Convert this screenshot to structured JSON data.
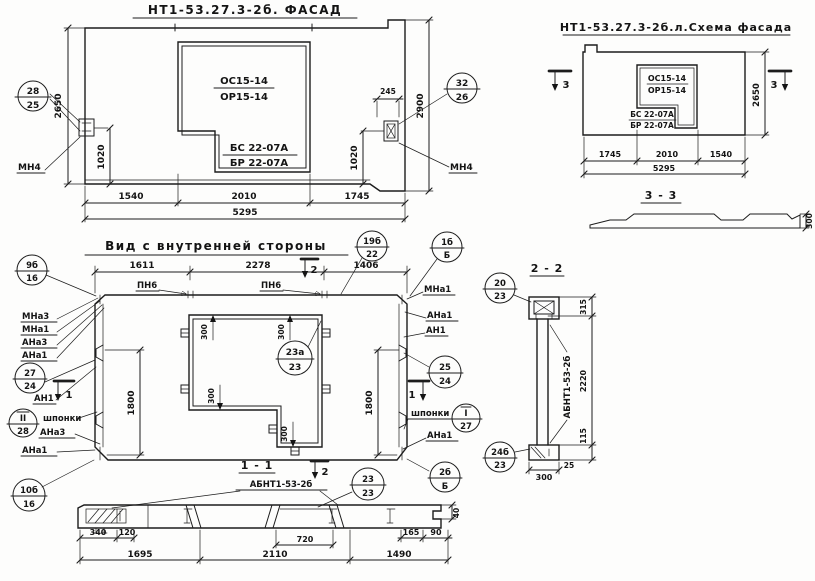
{
  "shared": {
    "abnt": "АБНТ1-53-2б"
  },
  "facade": {
    "title": "НТ1-53.27.3-2б. ФАСАД",
    "win_top": "ОС15-14",
    "win_bot": "ОР15-14",
    "lintel_top": "БС 22-07А",
    "lintel_bot": "БР 22-07А",
    "mn4": "МН4",
    "callout_left": {
      "top": "28",
      "bot": "25"
    },
    "callout_right": {
      "top": "32",
      "bot": "26"
    },
    "d2650": "2650",
    "d2900": "2900",
    "d1020": "1020",
    "d245": "245",
    "d1540": "1540",
    "d2010": "2010",
    "d1745": "1745",
    "d5295": "5295"
  },
  "schema": {
    "title": "НТ1-53.27.3-2б.л.Схема фасада",
    "win_top": "ОС15-14",
    "win_bot": "ОР15-14",
    "lintel_top": "БС 22-07А",
    "lintel_bot": "БР 22-07А",
    "mark3": "3",
    "d2650": "2650",
    "d1745": "1745",
    "d2010": "2010",
    "d1540": "1540",
    "d5295": "5295",
    "s33_title": "3 - 3",
    "d300": "300"
  },
  "inner": {
    "title": "Вид с внутренней стороны",
    "d1611": "1611",
    "d2278": "2278",
    "d1406": "1406",
    "pn6": "ПН6",
    "mark1": "1",
    "mark2": "2",
    "mna3": "МНа3",
    "mna1": "МНа1",
    "ana3": "АНа3",
    "ana1": "АНа1",
    "an1": "АН1",
    "shponki": "шпонки",
    "d300": "300",
    "d1800": "1800",
    "c9b": {
      "top": "9б",
      "bot": "16"
    },
    "c19b": {
      "top": "19б",
      "bot": "22"
    },
    "c1b": {
      "top": "1б",
      "bot": "Б"
    },
    "c27": {
      "top": "27",
      "bot": "24"
    },
    "cII": {
      "top": "II",
      "bot": "28"
    },
    "c10b": {
      "top": "10б",
      "bot": "16"
    },
    "c23a": {
      "top": "23а",
      "bot": "23"
    },
    "c25": {
      "top": "25",
      "bot": "24"
    },
    "cI": {
      "top": "I",
      "bot": "27"
    },
    "c2b": {
      "top": "2б",
      "bot": "Б"
    }
  },
  "s22": {
    "title": "2 - 2",
    "c20": {
      "top": "20",
      "bot": "23"
    },
    "c24b": {
      "top": "24б",
      "bot": "23"
    },
    "d315": "315",
    "d2220": "2220",
    "d115": "115",
    "d25": "25",
    "d300": "300"
  },
  "s11": {
    "title": "1 - 1",
    "c23": {
      "top": "23",
      "bot": "23"
    },
    "d40": "40",
    "d340": "340",
    "d120": "120",
    "d165": "165",
    "d90": "90",
    "d1695": "1695",
    "d2110": "2110",
    "d720": "720",
    "d1490": "1490"
  }
}
